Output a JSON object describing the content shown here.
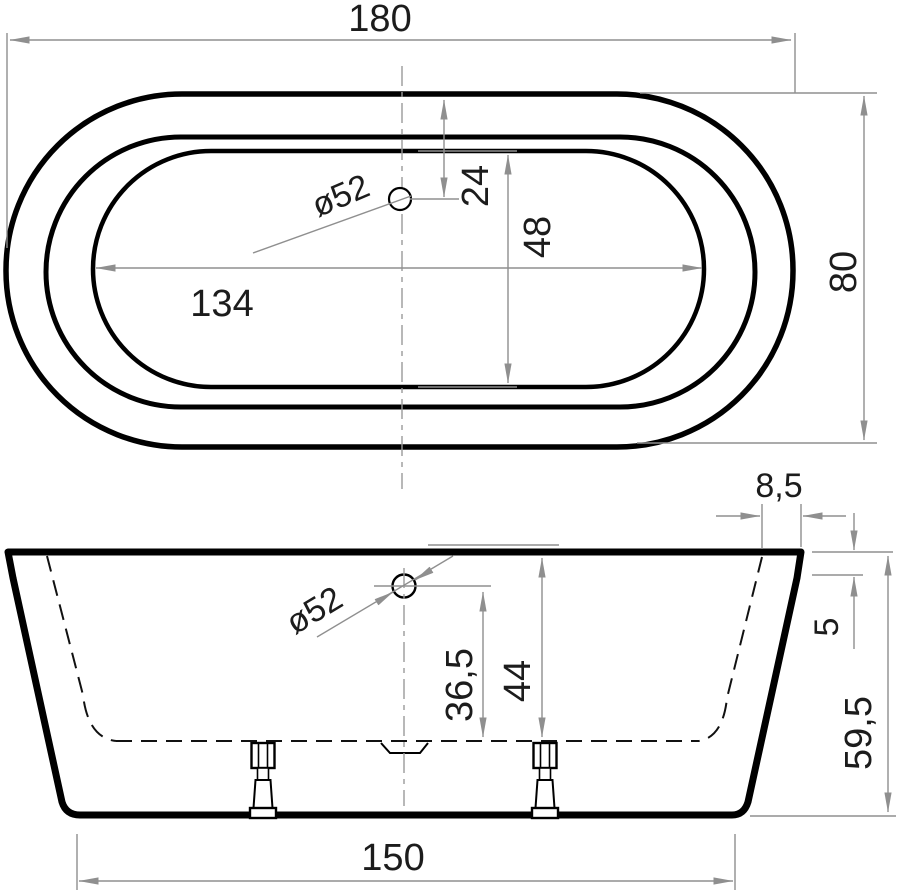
{
  "drawing_type": "bathtub technical drawing, two orthographic views",
  "colors": {
    "outline": "#000000",
    "dimension_lines": "#8f8f8f",
    "text": "#1c1c1c",
    "background": "#ffffff"
  },
  "views": {
    "top": {
      "label": "top view",
      "dims": {
        "overall_length": "180",
        "overall_width": "80",
        "inner_length": "134",
        "inner_width": "48",
        "drain_offset_from_end": "24",
        "drain_diameter": "ø52"
      }
    },
    "front": {
      "label": "front view",
      "dims": {
        "rim_top_width": "8,5",
        "rim_edge_height": "5",
        "overall_height": "59,5",
        "overflow_to_inner_floor": "36,5",
        "rim_to_inner_floor": "44",
        "base_length": "150",
        "overflow_diameter": "ø52"
      }
    }
  }
}
